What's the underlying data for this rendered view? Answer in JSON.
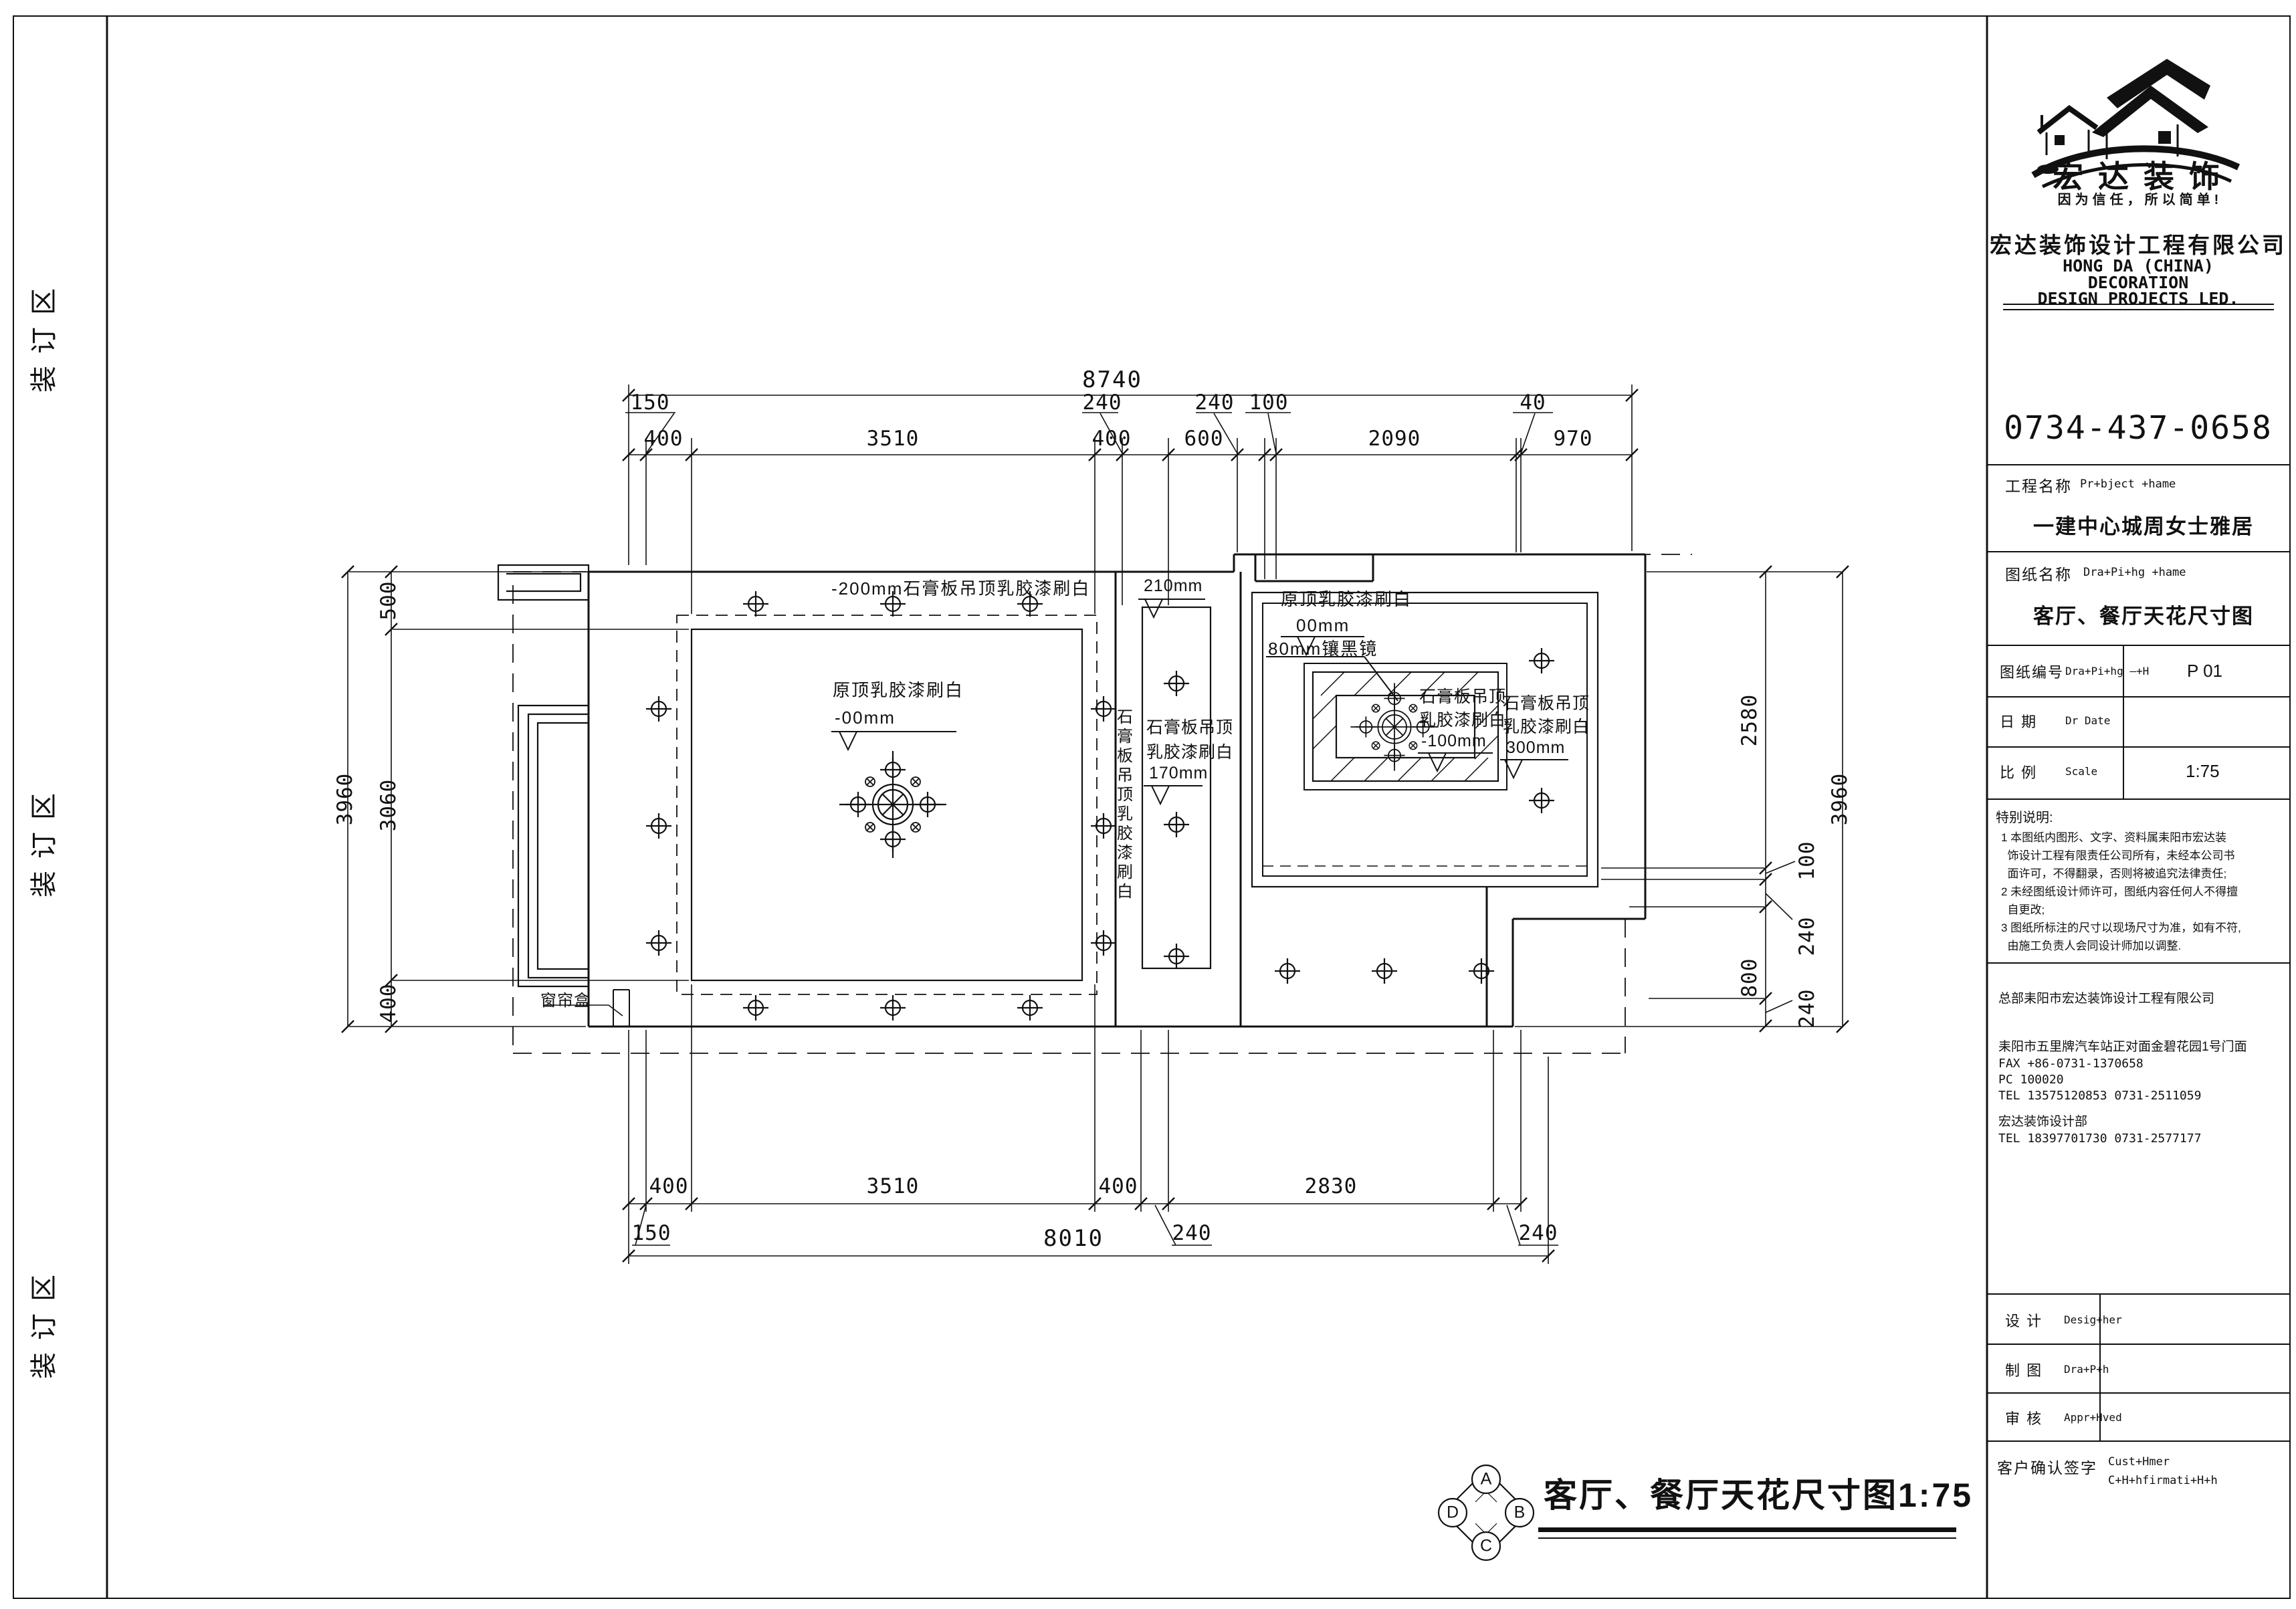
{
  "sheet": {
    "binding_label": "装订区"
  },
  "title_block": {
    "logo": {
      "brand": "宏达装饰",
      "slogan": "因为信任，所以简单!"
    },
    "company_cn": "宏达装饰设计工程有限公司",
    "company_en_lines": [
      "HONG DA (CHINA)",
      "DECORATION",
      "DESIGN PROJECTS LED."
    ],
    "phone": "0734-437-0658",
    "project": {
      "label_cn": "工程名称",
      "label_en": "Pr+bject +hame",
      "value": "一建中心城周女士雅居"
    },
    "drawing": {
      "label_cn": "图纸名称",
      "label_en": "Dra+Pi+hg +hame",
      "value": "客厅、餐厅天花尺寸图"
    },
    "number": {
      "label_cn": "图纸编号",
      "label_en": "Dra+Pi+hg —+H",
      "value": "P 01"
    },
    "date": {
      "label_cn": "日  期",
      "label_en": "Dr  Date",
      "value": ""
    },
    "scale": {
      "label_cn": "比  例",
      "label_en": "Scale",
      "value": "1:75"
    },
    "notes_title": "特别说明:",
    "notes": [
      "1 本图纸内图形、文字、资料属耒阳市宏达装",
      "  饰设计工程有限责任公司所有，未经本公司书",
      "  面许可，不得翻录，否则将被追究法律责任;",
      "2 未经图纸设计师许可，图纸内容任何人不得擅",
      "  自更改;",
      "3 图纸所标注的尺寸以现场尺寸为准，如有不符,",
      "  由施工负责人会同设计师加以调整."
    ],
    "hq": "总部耒阳市宏达装饰设计工程有限公司",
    "address": "耒阳市五里牌汽车站正对面金碧花园1号门面",
    "fax": "FAX +86-0731-1370658",
    "pc": "PC 100020",
    "tel1": "TEL 13575120853    0731-2511059",
    "dept": "宏达装饰设计部",
    "tel2": "TEL 18397701730    0731-2577177",
    "designer": {
      "label_cn": "设  计",
      "label_en": "Desig+her"
    },
    "drawn": {
      "label_cn": "制  图",
      "label_en": "Dra+P+h"
    },
    "approved": {
      "label_cn": "审  核",
      "label_en": "Appr+Hved"
    },
    "customer": {
      "label_cn": "客户确认签字",
      "label_en1": "Cust+Hmer",
      "label_en2": "C+H+hfirmati+H+h"
    }
  },
  "plan": {
    "ann": {
      "top": "-200mm石膏板吊顶乳胶漆刷白",
      "living1": "原顶乳胶漆刷白",
      "living2": "-00mm",
      "curtain": "窗帘盒",
      "strip_level": "210mm",
      "strip_side": "石膏板吊顶乳胶漆刷白",
      "strip1": "石膏板吊顶",
      "strip2": "乳胶漆刷白",
      "strip3": "170mm",
      "dining1": "原顶乳胶漆刷白",
      "dining2": "00mm",
      "mirror": "80mm镶黑镜",
      "frame1": "石膏板吊顶",
      "frame2": "乳胶漆刷白",
      "frame3": "-100mm",
      "right1": "石膏板吊顶",
      "right2": "乳胶漆刷白",
      "right3": "300mm"
    },
    "compass": {
      "a": "A",
      "b": "B",
      "c": "C",
      "d": "D"
    },
    "footer_title": "客厅、餐厅天花尺寸图1:75"
  },
  "dims": {
    "top": {
      "overall": "8740",
      "upper": [
        "150",
        "240",
        "240",
        "100",
        "40"
      ],
      "lower": [
        "400",
        "3510",
        "400",
        "600",
        "2090",
        "970"
      ]
    },
    "bottom": {
      "overall": "8010",
      "upper": [
        "400",
        "3510",
        "400",
        "2830"
      ],
      "lower": [
        "150",
        "240",
        "240"
      ]
    },
    "left": {
      "overall": "3960",
      "inner": [
        "500",
        "3060",
        "400"
      ]
    },
    "right": {
      "overall": "3960",
      "inner": [
        "2580",
        "100",
        "240",
        "800",
        "240"
      ]
    }
  }
}
